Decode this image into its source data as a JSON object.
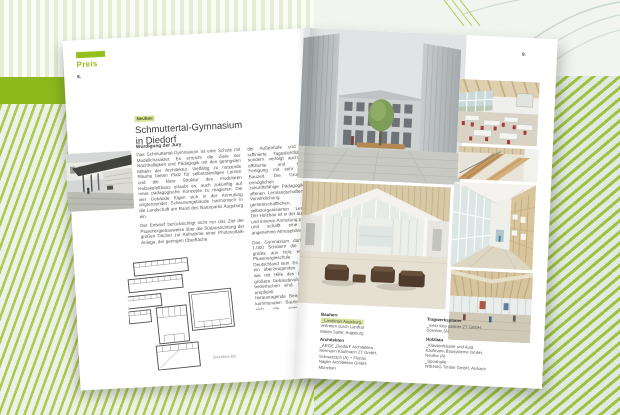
{
  "magazine": {
    "section_label": "Preis",
    "left_page_number": "8.",
    "right_page_number": "9.",
    "colors": {
      "accent_green": "#93c01f",
      "highlight_green": "#d7e59b",
      "band_green": "#8eb81c"
    },
    "article": {
      "category": "Neubau",
      "title_line1": "Schmuttertal-Gymnasium",
      "title_line2": "in Diedorf",
      "jury_heading": "Würdigung der Jury",
      "col1_par1": "Das Schmuttertal-Gymnasium ist eine Schule mit Modellcharakter. Es erreicht die Ziele der Nachhaltigkeit und Pädagogik mit den geringsten Mitteln der Architektur. Vielfältig zu nutzende Räume bieten Platz für selbstständiges Lernen und die klare Struktur des modularen Holzskelettbaus erlaubt es, auch zukünftig auf neue pädagogische Konzepte zu reagieren. Die vier Gebäude fügen sich in der Anmutung angrenzender Scheunengebäude harmonisch in die Landschaft am Rand des Naturparks Augsburg ein.",
      "col1_par2": "Der Entwurf berücksichtigt nicht nur das Ziel der Plusenergiebauweise über die Südausrichtung der großen Dächer zur Aufnahme einer Photovoltaik-Anlage, der geringen Oberfläche",
      "col2_par1": "der Außenhöfe und eine raffinierte Tageslichtführung, sondern verfolgt auch eine effiziente und serielle Fertigung mit sehr kurzer Bauzeit. Die Grundrisse ermöglichen eine zukunftsfähige Pädagogik mit offenen Lernlandschaften zur Verwirklichung gemeinschaftlichen, selbstorganisierten Lernens. Der Holzbau ist in der äußeren und inneren Anmutung präsent und schafft eine sehr angenehme Atmosphäre.",
      "col2_par2": "Das Gymnasium dürfte mit 1.000 Schülern die bislang größte aus Holz errichtete Plusenergieschule in Deutschland sein. Es ist auch ein überzeugendes Beispiel, wie mit Hilfe des Holzbaus größere Gebäudevolumina zu beherrschen sind. Die Jury empfiehlt dieses herausragende Beispiel allen kommunalen Bauherren, um sich die energetischen, bautechnischen und stofflichen Qualitäten des Baustoffes Holz zu erschließen.",
      "plan_caption": "Grundriss EG"
    },
    "credits": {
      "bauherr_heading": "Bauherr",
      "bauherr_line1": "_Landkreis Augsburg,",
      "bauherr_line2": "vertreten durch Landrat",
      "bauherr_line3": "Martin Sailer, Augsburg",
      "architekten_heading": "Architekten",
      "architekten_line1": "_ARGE „Diedorf“ Architekten",
      "architekten_line2": "Hermann Kaufmann ZT GmbH,",
      "architekten_line3": "Schwarzach (A) + Florian",
      "architekten_line4": "Nagler Architekten GmbH,",
      "architekten_line5": "München",
      "tragwerk_heading": "Tragwerksplaner",
      "tragwerk_line1": "_merz kley partner ZT GmbH,",
      "tragwerk_line2": "Dornbirn (A)",
      "holzbau_heading": "Holzbau",
      "holzbau_line1": "_Klassenhäuser und Aula:",
      "holzbau_line2": "Kaufmann Bausysteme GmbH,",
      "holzbau_line3": "Reuthe (A)",
      "holzbau_line4": "_Sporthalle:",
      "holzbau_line5": "WIEHAG Timber GmbH, Aichach"
    }
  }
}
